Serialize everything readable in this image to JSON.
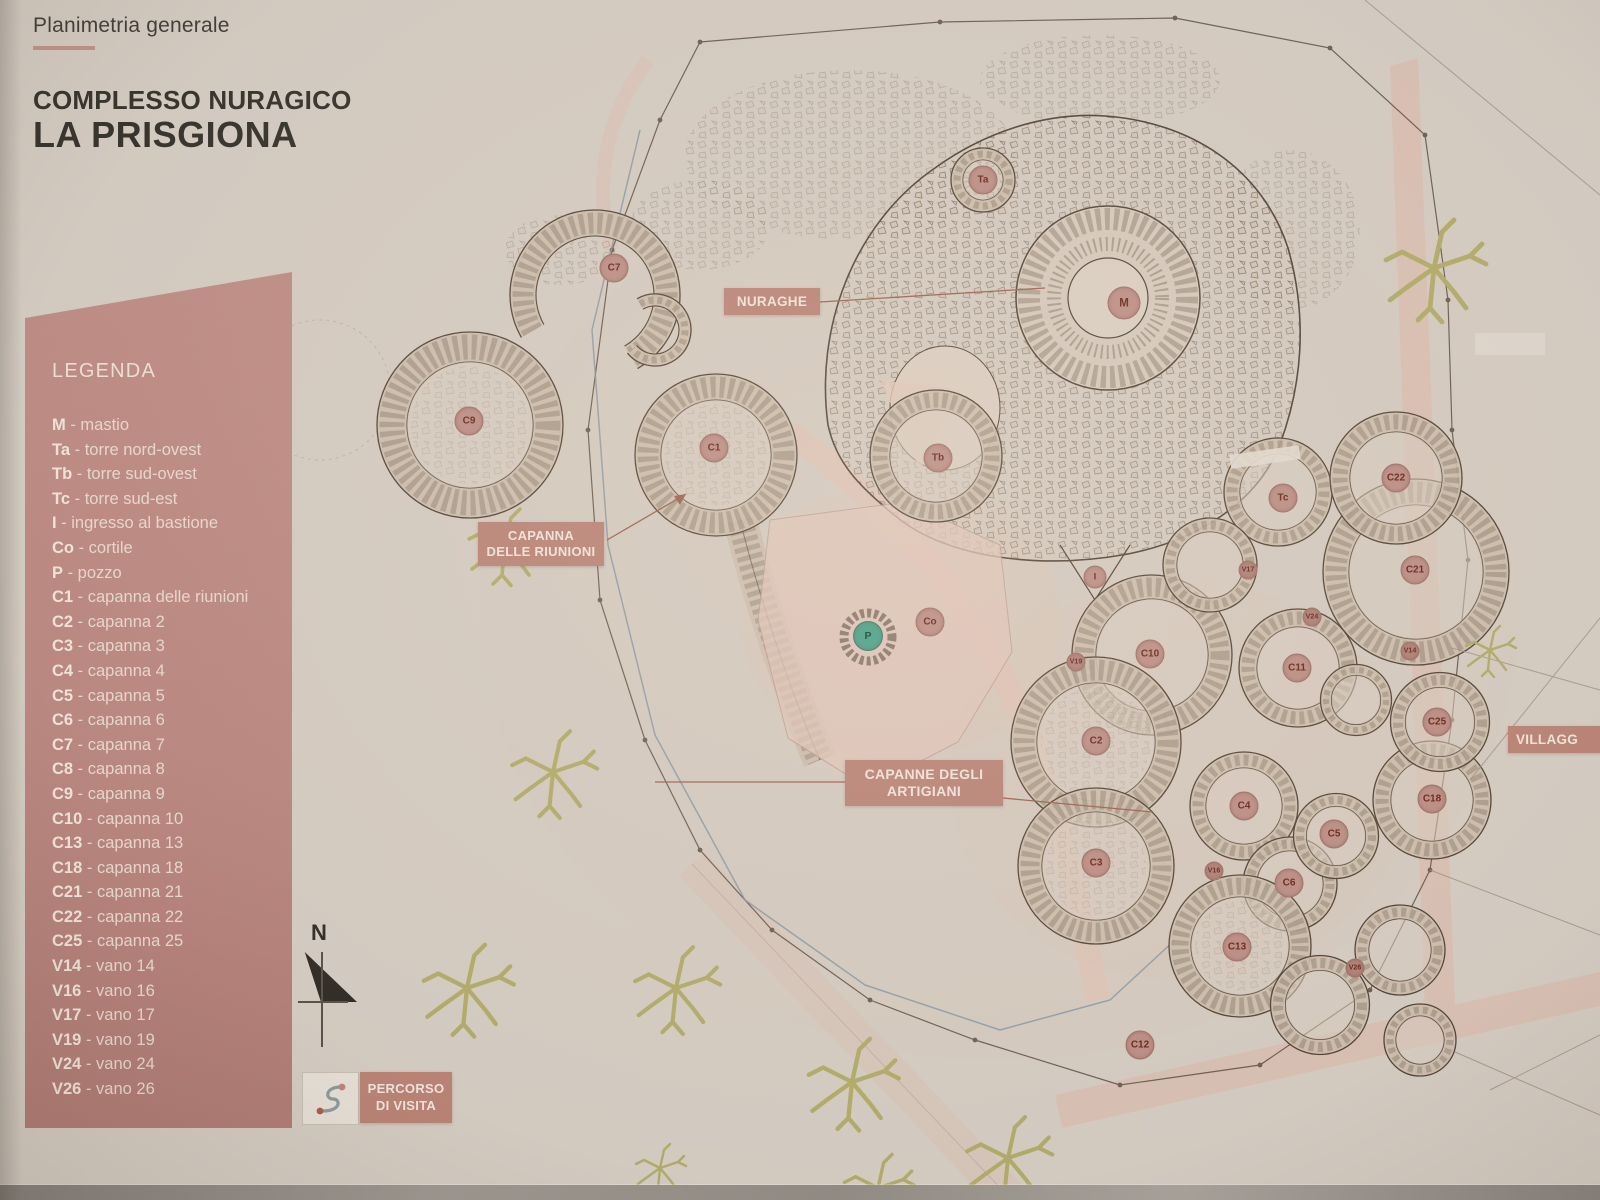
{
  "header": {
    "subtitle": "Planimetria generale",
    "title_line1": "COMPLESSO NURAGICO",
    "title_line2": "LA PRISGIONA"
  },
  "legend": {
    "title": "LEGENDA",
    "items": [
      {
        "key": "M",
        "label": "mastio"
      },
      {
        "key": "Ta",
        "label": "torre nord-ovest"
      },
      {
        "key": "Tb",
        "label": "torre sud-ovest"
      },
      {
        "key": "Tc",
        "label": "torre sud-est"
      },
      {
        "key": "I",
        "label": "ingresso al bastione"
      },
      {
        "key": "Co",
        "label": "cortile"
      },
      {
        "key": "P",
        "label": "pozzo"
      },
      {
        "key": "C1",
        "label": "capanna delle riunioni"
      },
      {
        "key": "C2",
        "label": "capanna 2"
      },
      {
        "key": "C3",
        "label": "capanna 3"
      },
      {
        "key": "C4",
        "label": "capanna 4"
      },
      {
        "key": "C5",
        "label": "capanna 5"
      },
      {
        "key": "C6",
        "label": "capanna 6"
      },
      {
        "key": "C7",
        "label": "capanna 7"
      },
      {
        "key": "C8",
        "label": "capanna 8"
      },
      {
        "key": "C9",
        "label": "capanna 9"
      },
      {
        "key": "C10",
        "label": "capanna 10"
      },
      {
        "key": "C13",
        "label": "capanna 13"
      },
      {
        "key": "C18",
        "label": "capanna 18"
      },
      {
        "key": "C21",
        "label": "capanna 21"
      },
      {
        "key": "C22",
        "label": "capanna 22"
      },
      {
        "key": "C25",
        "label": "capanna 25"
      },
      {
        "key": "V14",
        "label": "vano 14"
      },
      {
        "key": "V16",
        "label": "vano 16"
      },
      {
        "key": "V17",
        "label": "vano 17"
      },
      {
        "key": "V19",
        "label": "vano 19"
      },
      {
        "key": "V24",
        "label": "vano 24"
      },
      {
        "key": "V26",
        "label": "vano 26"
      }
    ]
  },
  "map_labels": {
    "nuraghe": "NURAGHE",
    "riunioni_line1": "CAPANNA",
    "riunioni_line2": "DELLE RIUNIONI",
    "artigiani_line1": "CAPANNE DEGLI",
    "artigiani_line2": "ARTIGIANI",
    "villaggio": "VILLAGG",
    "percorso_line1": "PERCORSO",
    "percorso_line2": "DI VISITA",
    "north": "N"
  },
  "markers": [
    {
      "label": "Ta",
      "x": 983,
      "y": 180,
      "type": "tower"
    },
    {
      "label": "M",
      "x": 1124,
      "y": 303,
      "type": "tower-large"
    },
    {
      "label": "C7",
      "x": 614,
      "y": 268,
      "type": "hut"
    },
    {
      "label": "C9",
      "x": 469,
      "y": 421,
      "type": "hut"
    },
    {
      "label": "C1",
      "x": 714,
      "y": 448,
      "type": "hut"
    },
    {
      "label": "Tb",
      "x": 938,
      "y": 458,
      "type": "tower"
    },
    {
      "label": "Tc",
      "x": 1283,
      "y": 498,
      "type": "tower"
    },
    {
      "label": "C22",
      "x": 1396,
      "y": 478,
      "type": "hut"
    },
    {
      "label": "C21",
      "x": 1415,
      "y": 570,
      "type": "hut"
    },
    {
      "label": "I",
      "x": 1095,
      "y": 577,
      "type": "entry"
    },
    {
      "label": "Co",
      "x": 930,
      "y": 622,
      "type": "hut"
    },
    {
      "label": "P",
      "x": 868,
      "y": 636,
      "type": "well"
    },
    {
      "label": "C10",
      "x": 1150,
      "y": 654,
      "type": "hut"
    },
    {
      "label": "C11",
      "x": 1297,
      "y": 668,
      "type": "hut"
    },
    {
      "label": "V17",
      "x": 1248,
      "y": 570,
      "type": "small"
    },
    {
      "label": "V19",
      "x": 1076,
      "y": 662,
      "type": "small"
    },
    {
      "label": "V24",
      "x": 1312,
      "y": 617,
      "type": "small"
    },
    {
      "label": "V14",
      "x": 1410,
      "y": 651,
      "type": "small"
    },
    {
      "label": "C25",
      "x": 1437,
      "y": 722,
      "type": "hut"
    },
    {
      "label": "C2",
      "x": 1096,
      "y": 741,
      "type": "hut"
    },
    {
      "label": "C4",
      "x": 1244,
      "y": 806,
      "type": "hut"
    },
    {
      "label": "C18",
      "x": 1432,
      "y": 799,
      "type": "hut"
    },
    {
      "label": "C5",
      "x": 1334,
      "y": 834,
      "type": "hut"
    },
    {
      "label": "C3",
      "x": 1096,
      "y": 863,
      "type": "hut"
    },
    {
      "label": "C6",
      "x": 1289,
      "y": 883,
      "type": "hut"
    },
    {
      "label": "V16",
      "x": 1214,
      "y": 871,
      "type": "small"
    },
    {
      "label": "C13",
      "x": 1237,
      "y": 947,
      "type": "hut"
    },
    {
      "label": "V26",
      "x": 1355,
      "y": 968,
      "type": "small"
    },
    {
      "label": "C12",
      "x": 1140,
      "y": 1045,
      "type": "hut"
    }
  ],
  "trees": [
    {
      "x": 505,
      "y": 545,
      "s": 1.5
    },
    {
      "x": 553,
      "y": 772,
      "s": 1.7
    },
    {
      "x": 467,
      "y": 988,
      "s": 1.8
    },
    {
      "x": 676,
      "y": 988,
      "s": 1.7
    },
    {
      "x": 852,
      "y": 1082,
      "s": 1.8
    },
    {
      "x": 1008,
      "y": 1158,
      "s": 1.7
    },
    {
      "x": 878,
      "y": 1188,
      "s": 1.4
    },
    {
      "x": 660,
      "y": 1168,
      "s": 1.0
    },
    {
      "x": 1434,
      "y": 268,
      "s": 2.0
    },
    {
      "x": 1490,
      "y": 650,
      "s": 1.0
    }
  ],
  "colors": {
    "paper": "#d6cec5",
    "legend_bg": "#bb8881",
    "label_bg": "#ba8376",
    "marker_fill": "#bd8e86",
    "marker_text": "#662319",
    "well_fill": "#43a189",
    "tree": "#b2ad68",
    "ink": "#4a3b2f",
    "path_pink": "#dcbfb2"
  }
}
